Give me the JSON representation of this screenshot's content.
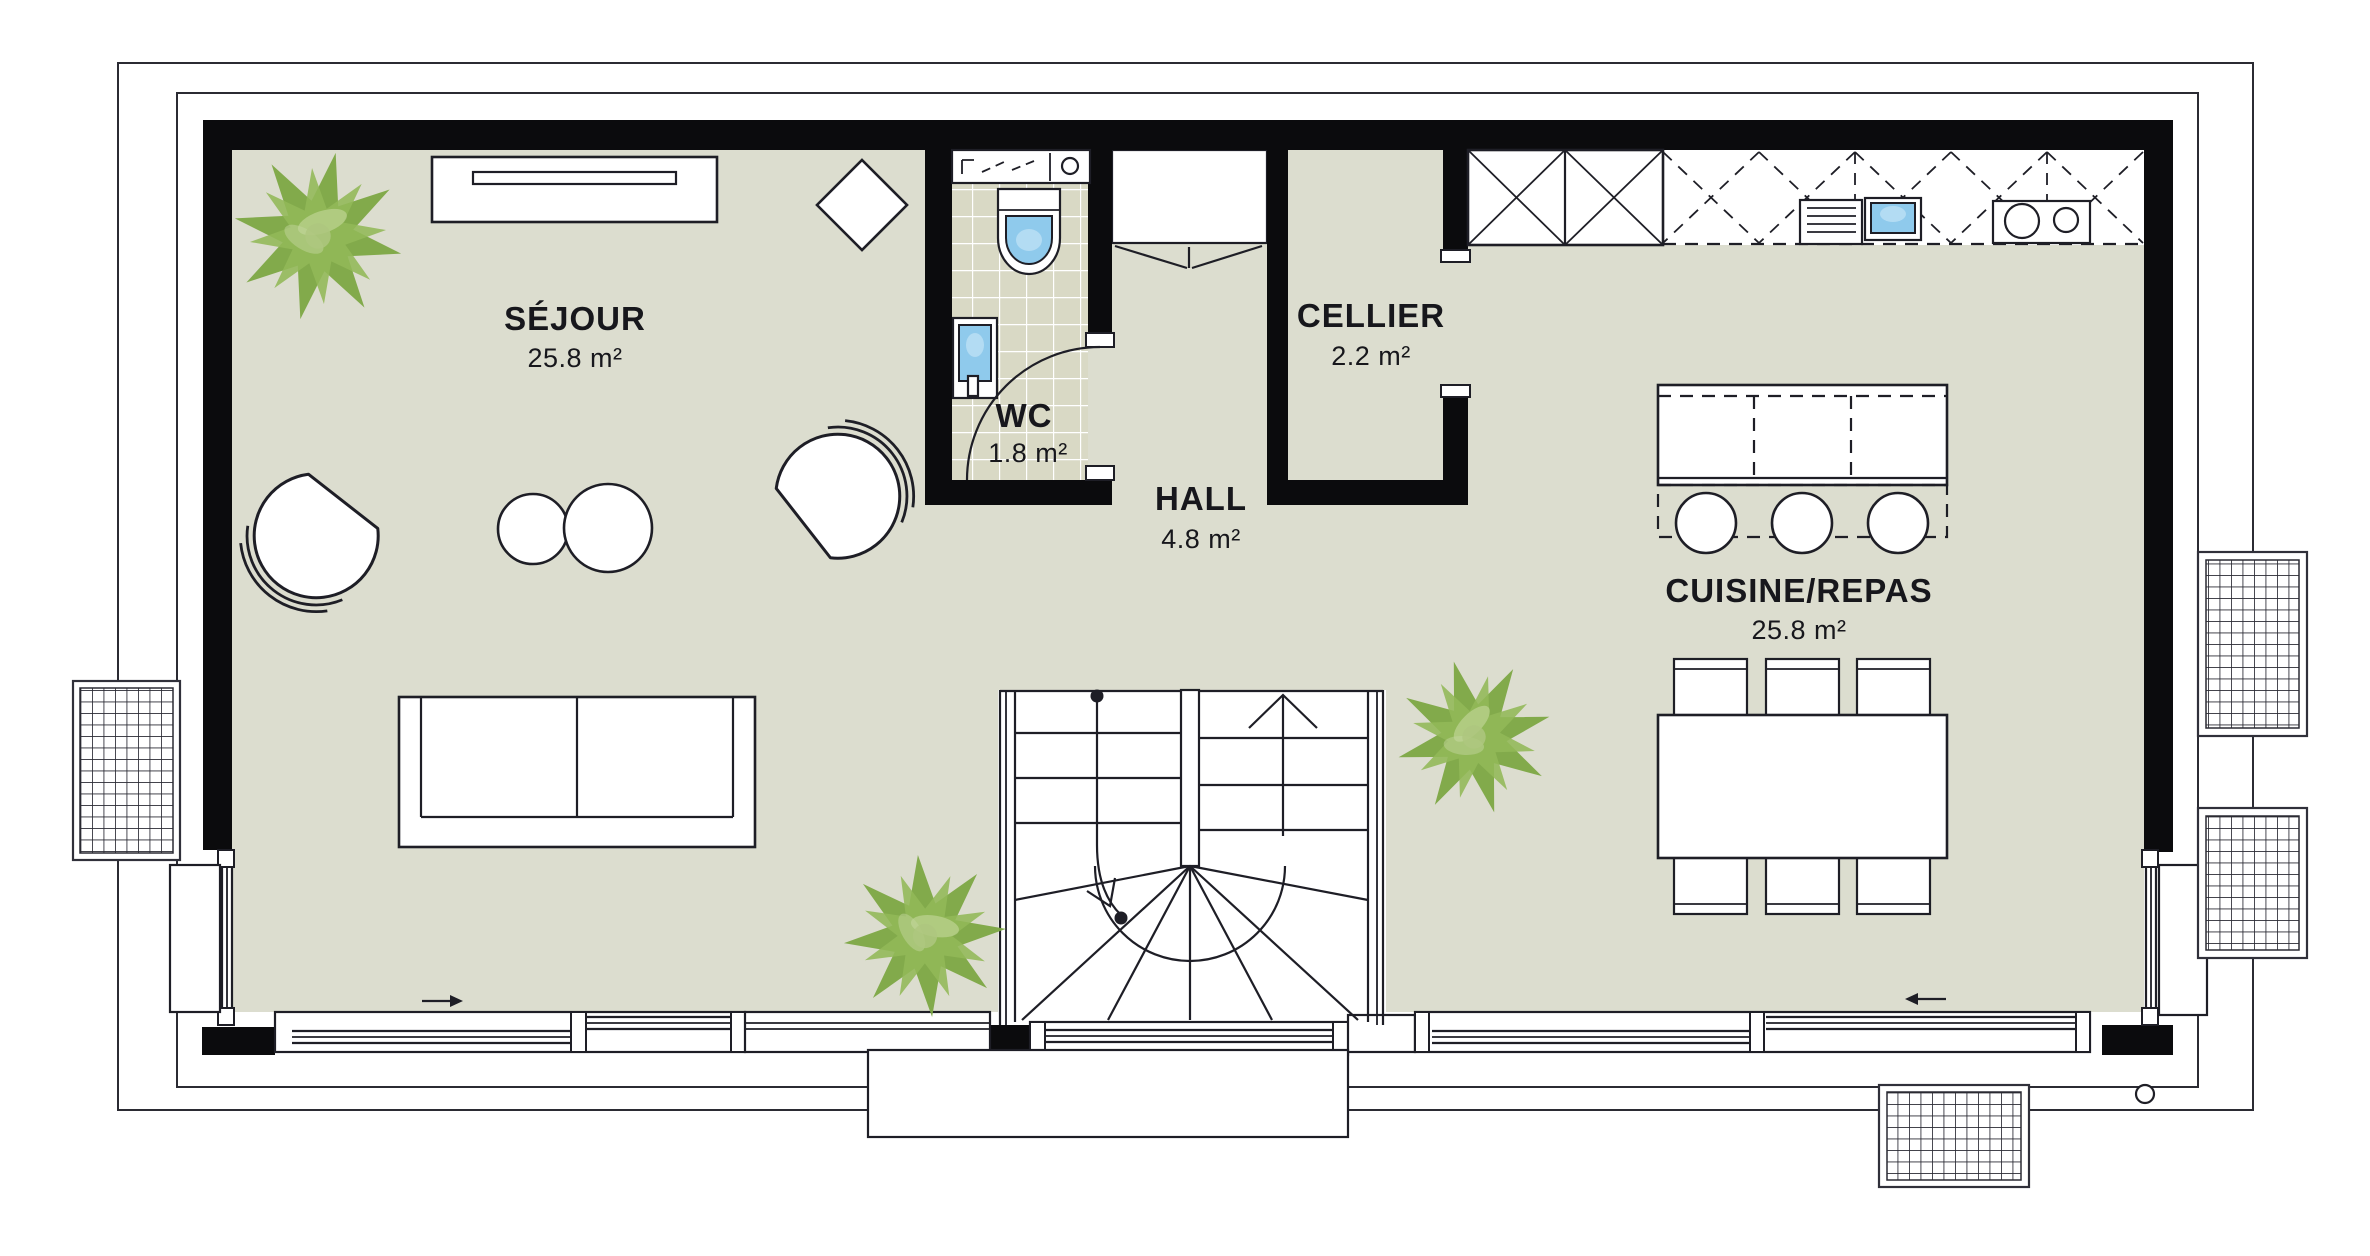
{
  "rooms": [
    {
      "label": "SÉJOUR",
      "area": "25.8 m²"
    },
    {
      "label": "WC",
      "area": "1.8 m²"
    },
    {
      "label": "HALL",
      "area": "4.8 m²"
    },
    {
      "label": "CELLIER",
      "area": "2.2 m²"
    },
    {
      "label": "CUISINE/REPAS",
      "area": "25.8 m²"
    }
  ],
  "icons": {
    "plant": "potted-plant-star-leaves",
    "slide_right": "→",
    "slide_left": "←",
    "stairs_up": "↑",
    "door_swing": "quarter-circle-arc"
  },
  "colors": {
    "background": "#FFFFFF",
    "floor": "#DCDDCF",
    "wc_tile": "#D9D9C5",
    "wall": "#0B0B0D",
    "line": "#1E1E26",
    "water": "#8FCAEC",
    "plant_dark": "#7CA743",
    "plant_light": "#92B858",
    "text": "#17171C"
  }
}
